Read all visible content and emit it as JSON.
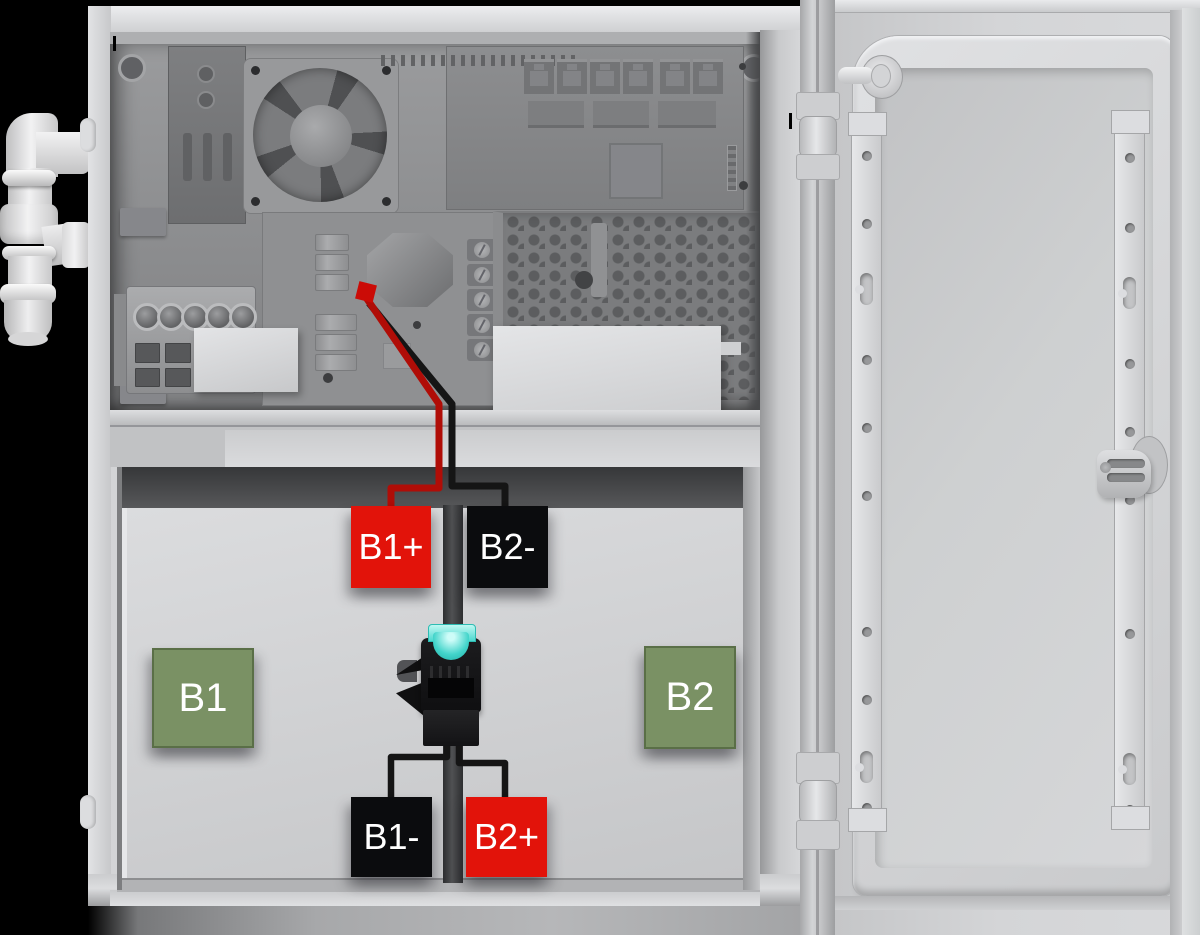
{
  "diagram": {
    "type": "battery-enclosure-wiring",
    "battery_labels": {
      "b1": "B1",
      "b2": "B2"
    },
    "terminal_labels": {
      "b1_positive": "B1+",
      "b1_negative": "B1-",
      "b2_positive": "B2+",
      "b2_negative": "B2-"
    },
    "colors": {
      "positive_terminal": "#e2130a",
      "negative_terminal": "#0b0c0e",
      "battery_marker": "#7a9164",
      "wire_positive": "#b00d07",
      "wire_negative": "#151515",
      "arrow_marker": "#cb0b06",
      "fuse": "#45d8ce"
    }
  }
}
